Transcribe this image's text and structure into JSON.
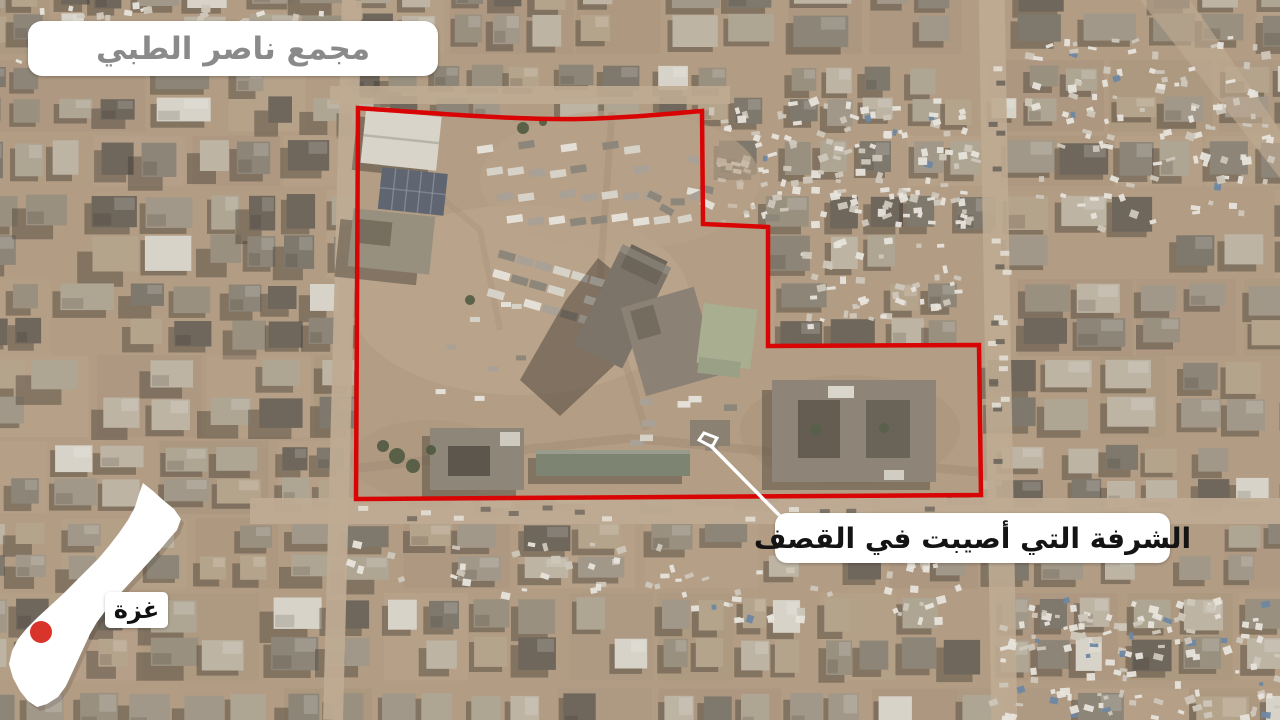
{
  "labels": {
    "title": {
      "text": "مجمع ناصر الطبي",
      "x": 28,
      "y": 21,
      "w": 410,
      "h": 55,
      "text_color": "#8a8a8a",
      "bg": "#ffffff"
    },
    "callout": {
      "text": "الشرفة التي أصيبت في القصف",
      "x": 775,
      "y": 513,
      "w": 395,
      "h": 50,
      "text_color": "#141414",
      "bg": "#ffffff"
    },
    "map": {
      "text": "غزة",
      "x": 105,
      "y": 592,
      "w": 63,
      "h": 36,
      "text_color": "#111111",
      "bg": "#ffffff"
    }
  },
  "outline": {
    "color": "#d90404",
    "width": 4.5,
    "path": "M 358 108 C 440 114 520 120 580 119 C 625 118 668 114 702 111 L 703 224 L 768 227 L 768 346 L 979 345 L 981 495 L 356 499 Z"
  },
  "marker": {
    "points": "699,440 704,433 717,438 712,447",
    "color": "#ffffff",
    "width": 3
  },
  "leader_line": {
    "x1": 711,
    "y1": 446,
    "x2": 781,
    "y2": 517,
    "color": "#ffffff",
    "width": 3.5
  },
  "minimap": {
    "fill": "#ffffff",
    "shape_points": "143,483 153,491 163,500 174,509 181,519 177,530 169,539 159,551 149,562 138,574 127,586 116,598 106,610 97,622 90,634 84,647 78,660 72,673 66,686 58,697 47,704 37,707 28,701 20,691 13,678 9,664 12,651 18,639 27,628 38,617 50,606 62,595 74,583 86,571 98,559 109,546 119,533 128,520 135,507 139,494",
    "dot": {
      "cx": 41,
      "cy": 632,
      "r": 11,
      "color": "#d9342b"
    }
  },
  "scene_colors": {
    "ground": "#b29c84",
    "street": "#bfab92",
    "compound_ground": "#b39d84",
    "shadow": "#423b33",
    "outline_red": "#d90404"
  }
}
